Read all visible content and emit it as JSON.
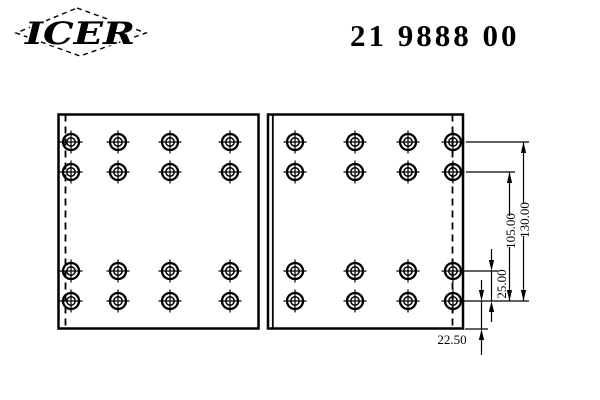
{
  "header": {
    "logo_text": "ICER",
    "part_number": "21 9888 00"
  },
  "drawing": {
    "dimensions": {
      "d130": "130.00",
      "d105": "105.00",
      "d25": "25.00",
      "d22_50": "22.50"
    },
    "holes": {
      "rows_y": [
        142,
        172,
        271,
        301
      ],
      "left_panel_cols_x": [
        71,
        118,
        170,
        230
      ],
      "right_panel_cols_x": [
        295,
        355,
        408,
        453
      ]
    }
  }
}
